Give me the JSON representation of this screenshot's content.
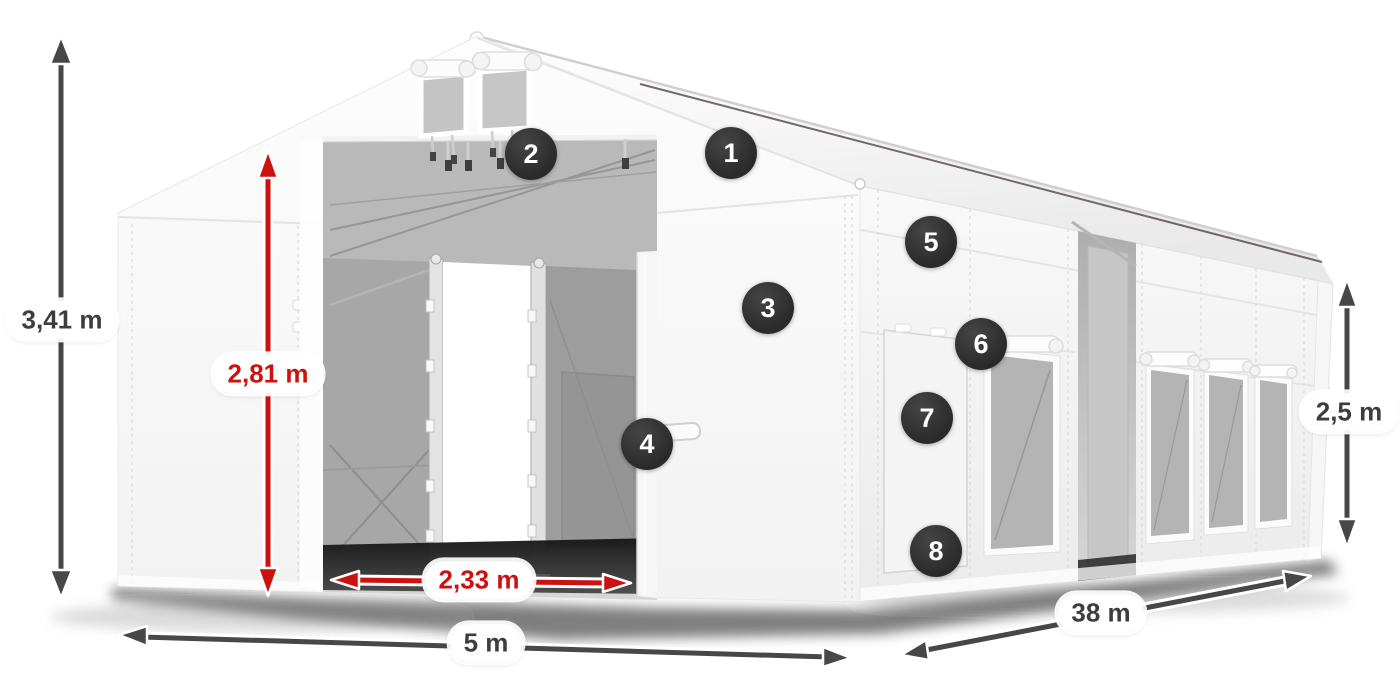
{
  "colors": {
    "accent_red": "#cc1111",
    "arrow_dark": "#474747",
    "badge_bg": "#2a2a2a",
    "badge_text": "#ffffff",
    "pill_bg": "#ffffff",
    "pill_text_dark": "#3d3d3d"
  },
  "dimensions": {
    "total_height": {
      "label": "3,41 m",
      "style": "dark"
    },
    "clear_height": {
      "label": "2,81 m",
      "style": "red"
    },
    "door_width": {
      "label": "2,33 m",
      "style": "red"
    },
    "width": {
      "label": "5 m",
      "style": "dark"
    },
    "length": {
      "label": "38 m",
      "style": "dark"
    },
    "side_height": {
      "label": "2,5 m",
      "style": "dark"
    }
  },
  "callouts": [
    {
      "number": "1"
    },
    {
      "number": "2"
    },
    {
      "number": "3"
    },
    {
      "number": "4"
    },
    {
      "number": "5"
    },
    {
      "number": "6"
    },
    {
      "number": "7"
    },
    {
      "number": "8"
    }
  ]
}
